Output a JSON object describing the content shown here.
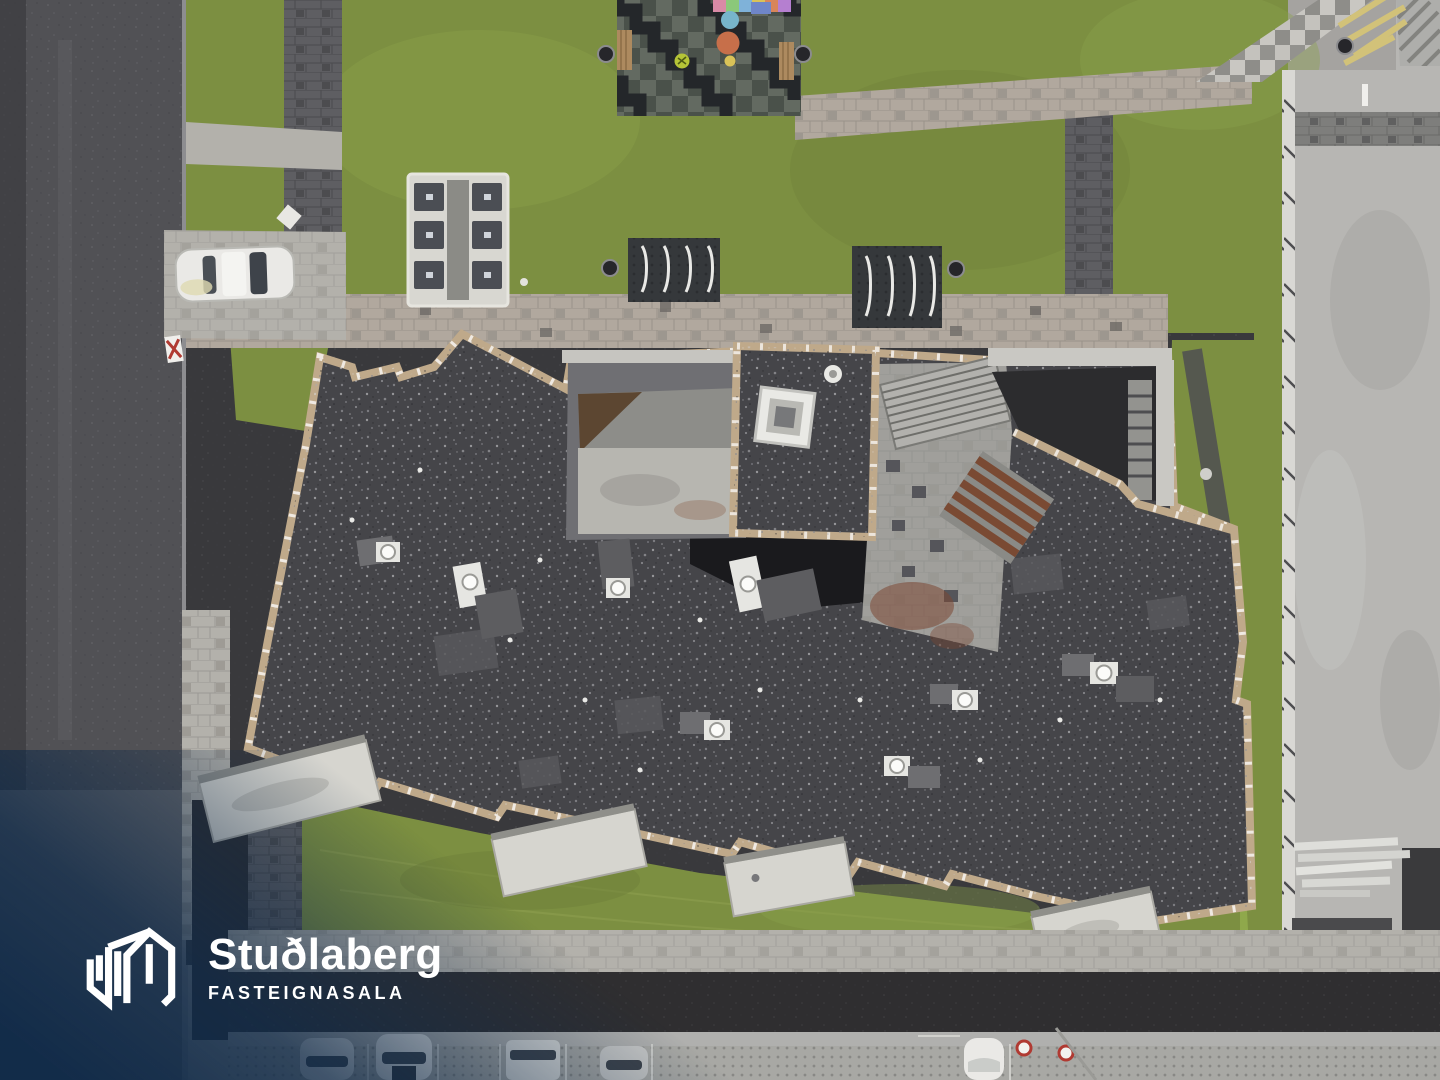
{
  "meta": {
    "description": "Aerial drone photograph looking straight down on a newly built apartment block with a dark gravel flat roof, surrounded by lawns, paved walkways, a street, parking with cars, a playground and an adjacent building under construction.",
    "width_px": 1440,
    "height_px": 1080
  },
  "branding": {
    "name": "Stuðlaberg",
    "tagline": "FASTEIGNASALA",
    "text_color": "#ffffff",
    "overlay_navy": "#10294a"
  },
  "scene": {
    "colors": {
      "road": "#515155",
      "road_light": "#6c6c70",
      "pavement": "#b3b1ab",
      "pavement_pink": "#b1a89e",
      "pavers_dark": "#5e5e62",
      "grass": "#7c8f41",
      "grass_light": "#8fa84b",
      "grass_dark": "#68793a",
      "roof_gravel": "#454549",
      "roof_valley": "#1a1a1d",
      "roof_patch": "#59595d",
      "parapet_tan": "#bfa98a",
      "white_concrete": "#d6d5cf",
      "court_concrete": "#a09f9b",
      "wall_gray": "#6f6f73",
      "deck": "#b7b6b3",
      "deck_band": "#7e7e7c",
      "soil": "#2f2e30",
      "rust": "#7b4733",
      "car_white": "#eae9e6",
      "glass": "#3e434a",
      "playground_base": "#636a61",
      "playground_mid": "#4a514a",
      "playground_black": "#24272a",
      "bench_wood": "#ad8a5f",
      "dome_blue": "#77b5cb",
      "dome_orange": "#c76f4a",
      "dome_yellow": "#d9c258",
      "ball_green": "#b5c437",
      "bin_gray": "#4b4e54",
      "bike_pad": "#35383b",
      "lumber_yellow": "#d2c279",
      "skylight_white": "#e9e9e5"
    },
    "regions": [
      {
        "name": "street",
        "desc": "asphalt street, left edge"
      },
      {
        "name": "main-roof",
        "desc": "dark gravel flat roof of apartment building"
      },
      {
        "name": "west-courtyard",
        "desc": "recessed terrace with concrete deck"
      },
      {
        "name": "stair-courtyard",
        "desc": "recessed court with staircases and rust stains"
      },
      {
        "name": "skylight",
        "desc": "square rooftop skylight"
      },
      {
        "name": "playground",
        "desc": "rubber-tiled playground with play domes and benches"
      },
      {
        "name": "construction-deck",
        "desc": "neighbouring building under construction, right side"
      },
      {
        "name": "parking",
        "desc": "permeable paver parking with cars, bottom edge"
      }
    ],
    "counts": {
      "cars_parked_bottom": 5,
      "car_on_street": 1,
      "waste_bins": 6,
      "bike_rack_pads": 2,
      "balcony_slabs": 4
    }
  }
}
